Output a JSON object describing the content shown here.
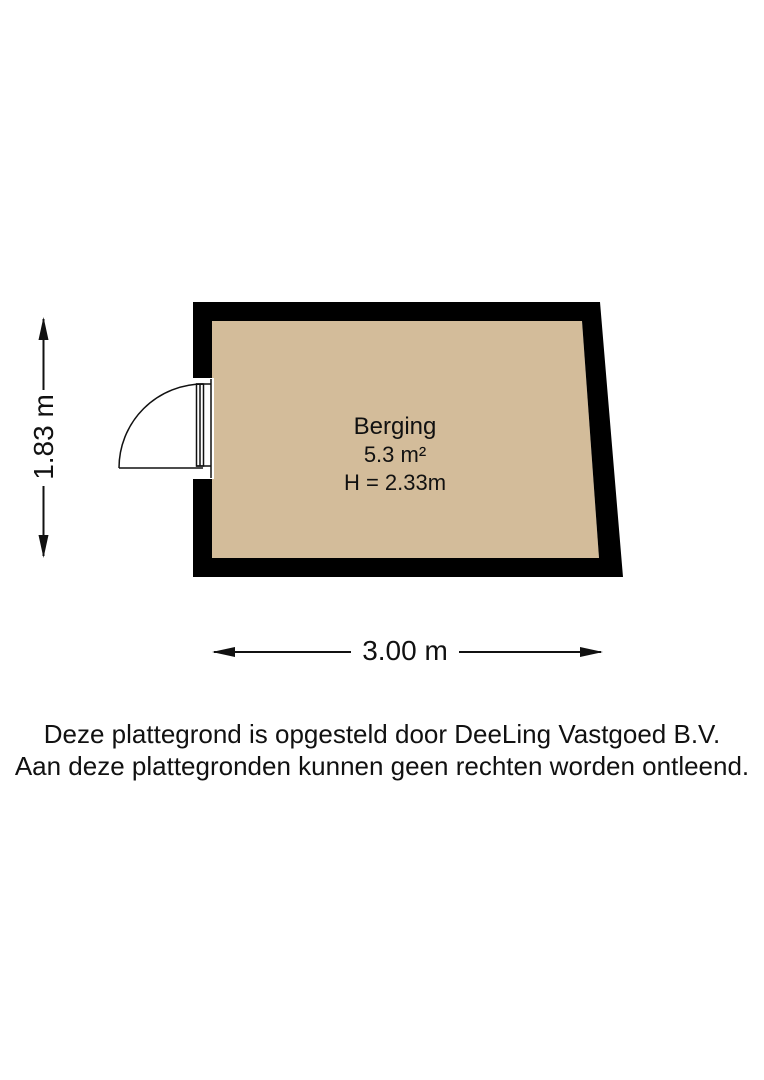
{
  "floorplan": {
    "room": {
      "name": "Berging",
      "area": "5.3 m²",
      "ceiling_height": "H = 2.33m"
    },
    "dimensions": {
      "width": "3.00 m",
      "height": "1.83 m"
    },
    "door": {
      "type": "single-swing-door",
      "wall": "left"
    },
    "colors": {
      "wall": "#000000",
      "floor": "#d3bc9a",
      "line": "#111111",
      "background": "#ffffff"
    }
  },
  "footer": {
    "line1": "Deze plattegrond is opgesteld door DeeLing Vastgoed B.V.",
    "line2": "Aan deze plattegronden kunnen geen rechten worden ontleend."
  }
}
